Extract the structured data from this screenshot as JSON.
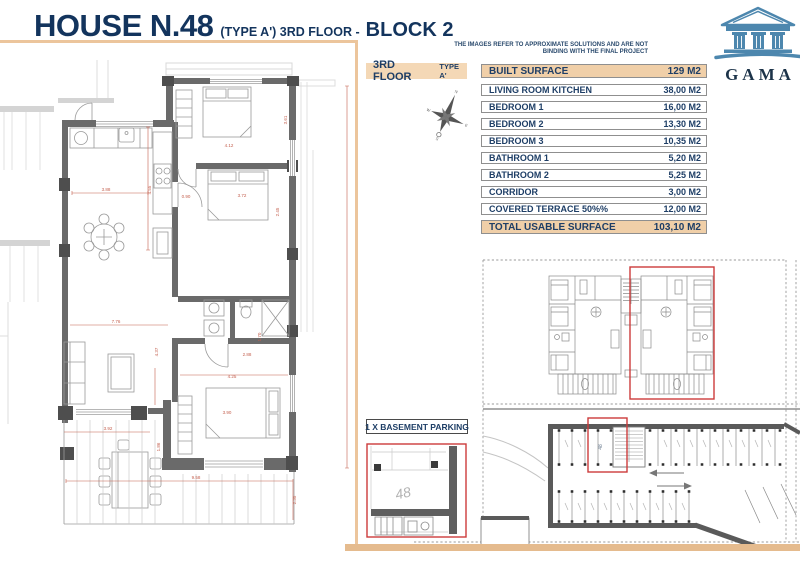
{
  "header": {
    "title_main": "HOUSE N.48",
    "title_mid": "(TYPE A') 3RD FLOOR -",
    "title_block": "BLOCK 2",
    "disclaimer_line1": "THE IMAGES REFER TO APPROXIMATE SOLUTIONS AND ARE NOT",
    "disclaimer_line2": "BINDING WITH THE FINAL PROJECT"
  },
  "logo": {
    "name": "GAMA"
  },
  "floor_badge": {
    "floor": "3RD FLOOR",
    "type": "TYPE A'"
  },
  "surface_table": {
    "header": {
      "label": "BUILT SURFACE",
      "value": "129 M2"
    },
    "rows": [
      {
        "label": "LIVING ROOM KITCHEN",
        "value": "38,00 M2"
      },
      {
        "label": "BEDROOM 1",
        "value": "16,00 M2"
      },
      {
        "label": "BEDROOM 2",
        "value": "13,30 M2"
      },
      {
        "label": "BEDROOM 3",
        "value": "10,35 M2"
      },
      {
        "label": "BATHROOM 1",
        "value": "5,20 M2"
      },
      {
        "label": "BATHROOM 2",
        "value": "5,25 M2"
      },
      {
        "label": "CORRIDOR",
        "value": "3,00 M2"
      },
      {
        "label": "COVERED TERRACE 50%%",
        "value": "12,00 M2"
      }
    ],
    "total": {
      "label": "TOTAL USABLE SURFACE",
      "value": "103,10 M2"
    }
  },
  "parking": {
    "label": "1 X BASEMENT PARKING",
    "space_number": "48"
  },
  "compass": {
    "n": "N",
    "e": "E",
    "s": "S",
    "w": "W"
  },
  "floor_plan": {
    "dimensions": [
      "3.88",
      "4.55",
      "0.90",
      "4.12",
      "3.61",
      "3.72",
      "2.45",
      "2.88",
      "1.70",
      "4.25",
      "7.76",
      "4.37",
      "3.92",
      "1.86",
      "3.90",
      "9.58",
      "2.35"
    ]
  },
  "colors": {
    "navy": "#1e3e66",
    "tan_line": "#ecc59c",
    "tan_fill": "#f0cfa8",
    "wall_gray": "#6a6a6a",
    "highlight_red": "#cc3b3b",
    "dimension_red": "#c4604f",
    "logo_blue": "#4d87ae"
  }
}
